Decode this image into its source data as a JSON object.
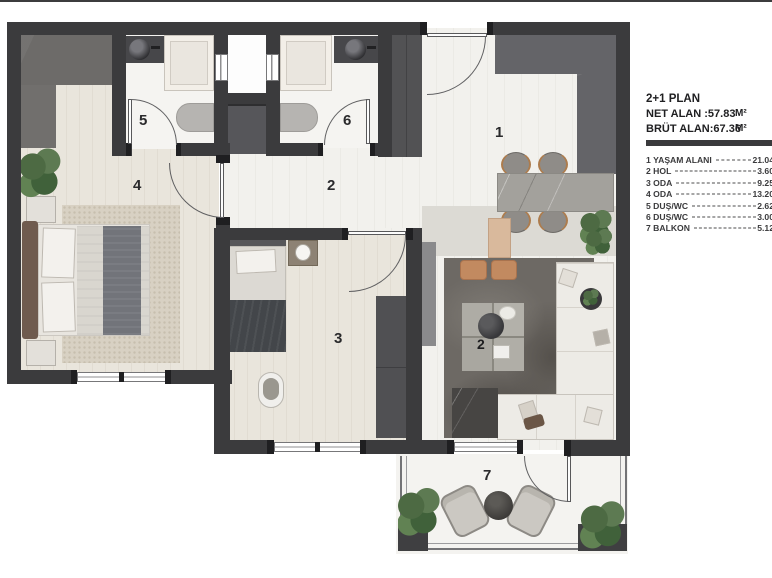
{
  "plan": {
    "room_labels": {
      "living": "1",
      "hall": "2",
      "room3": "3",
      "room4": "4",
      "bath5": "5",
      "bath6": "6",
      "balcony": "7",
      "coffee_table": "2"
    }
  },
  "legend": {
    "title": "2+1 PLAN",
    "net_line": "NET ALAN :57.83",
    "brut_line": "BRÜT ALAN:67.36",
    "unit": "M²",
    "rooms": [
      {
        "num": "1",
        "name": "YAŞAM ALANI",
        "area": "21.04"
      },
      {
        "num": "2",
        "name": "HOL",
        "area": "3.60"
      },
      {
        "num": "3",
        "name": "ODA",
        "area": "9.25"
      },
      {
        "num": "4",
        "name": "ODA",
        "area": "13.20"
      },
      {
        "num": "5",
        "name": "DUŞ/WC",
        "area": "2.62"
      },
      {
        "num": "6",
        "name": "DUŞ/WC",
        "area": "3.00"
      },
      {
        "num": "7",
        "name": "BALKON",
        "area": "5.12"
      }
    ]
  },
  "colors": {
    "wall": "#3b3b3d",
    "cabinet_gray": "#545456",
    "floor_wood": "#e9e5dc",
    "accent_tan": "#c28a60",
    "plant_green": "#54704a"
  }
}
